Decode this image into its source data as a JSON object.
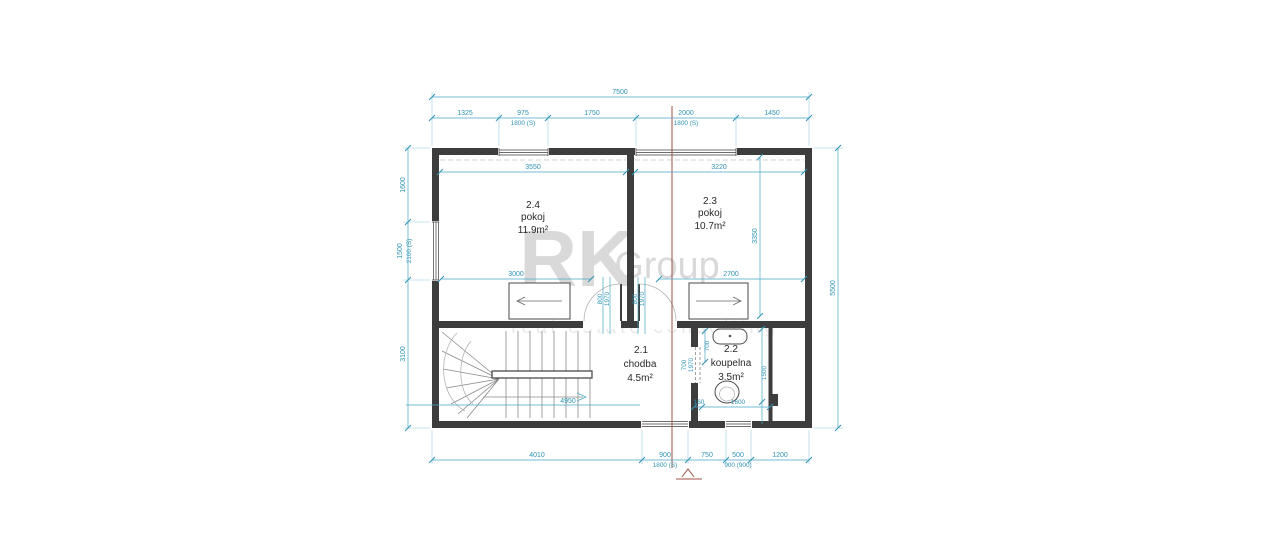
{
  "watermark": {
    "brand": "RK",
    "brand2": "Group",
    "tagline": "real estate consulting"
  },
  "rooms": {
    "r24": {
      "number": "2.4",
      "name": "pokoj",
      "area": "11.9m²"
    },
    "r23": {
      "number": "2.3",
      "name": "pokoj",
      "area": "10.7m²"
    },
    "r21": {
      "number": "2.1",
      "name": "chodba",
      "area": "4.5m²"
    },
    "r22": {
      "number": "2.2",
      "name": "koupelna",
      "area": "3.5m²"
    }
  },
  "dims": {
    "top_overall": "7500",
    "top": [
      "1325",
      "975",
      "1750",
      "2000",
      "1450"
    ],
    "top_sub": [
      "1800 (S)",
      "1800 (S)"
    ],
    "left": [
      "1600",
      "1500",
      "3100"
    ],
    "left_sub": "2100 (S)",
    "right_overall": "5500",
    "bottom": [
      "4010",
      "900",
      "750",
      "500",
      "1200"
    ],
    "bottom_sub": [
      "1800 (S)",
      "900 (900)"
    ],
    "room24_width": "3550",
    "room23_width": "3220",
    "room24_bed": "3000",
    "room23_bed": "2700",
    "room23_depth": "3350",
    "door24": [
      "800",
      "1970"
    ],
    "door23": [
      "800",
      "1970"
    ],
    "bath_door": [
      "700",
      "1970"
    ],
    "bath_fix": "700",
    "bath_height": "1500",
    "bath_bottom": [
      "160",
      "1600"
    ],
    "stair_walkline": "4950"
  }
}
